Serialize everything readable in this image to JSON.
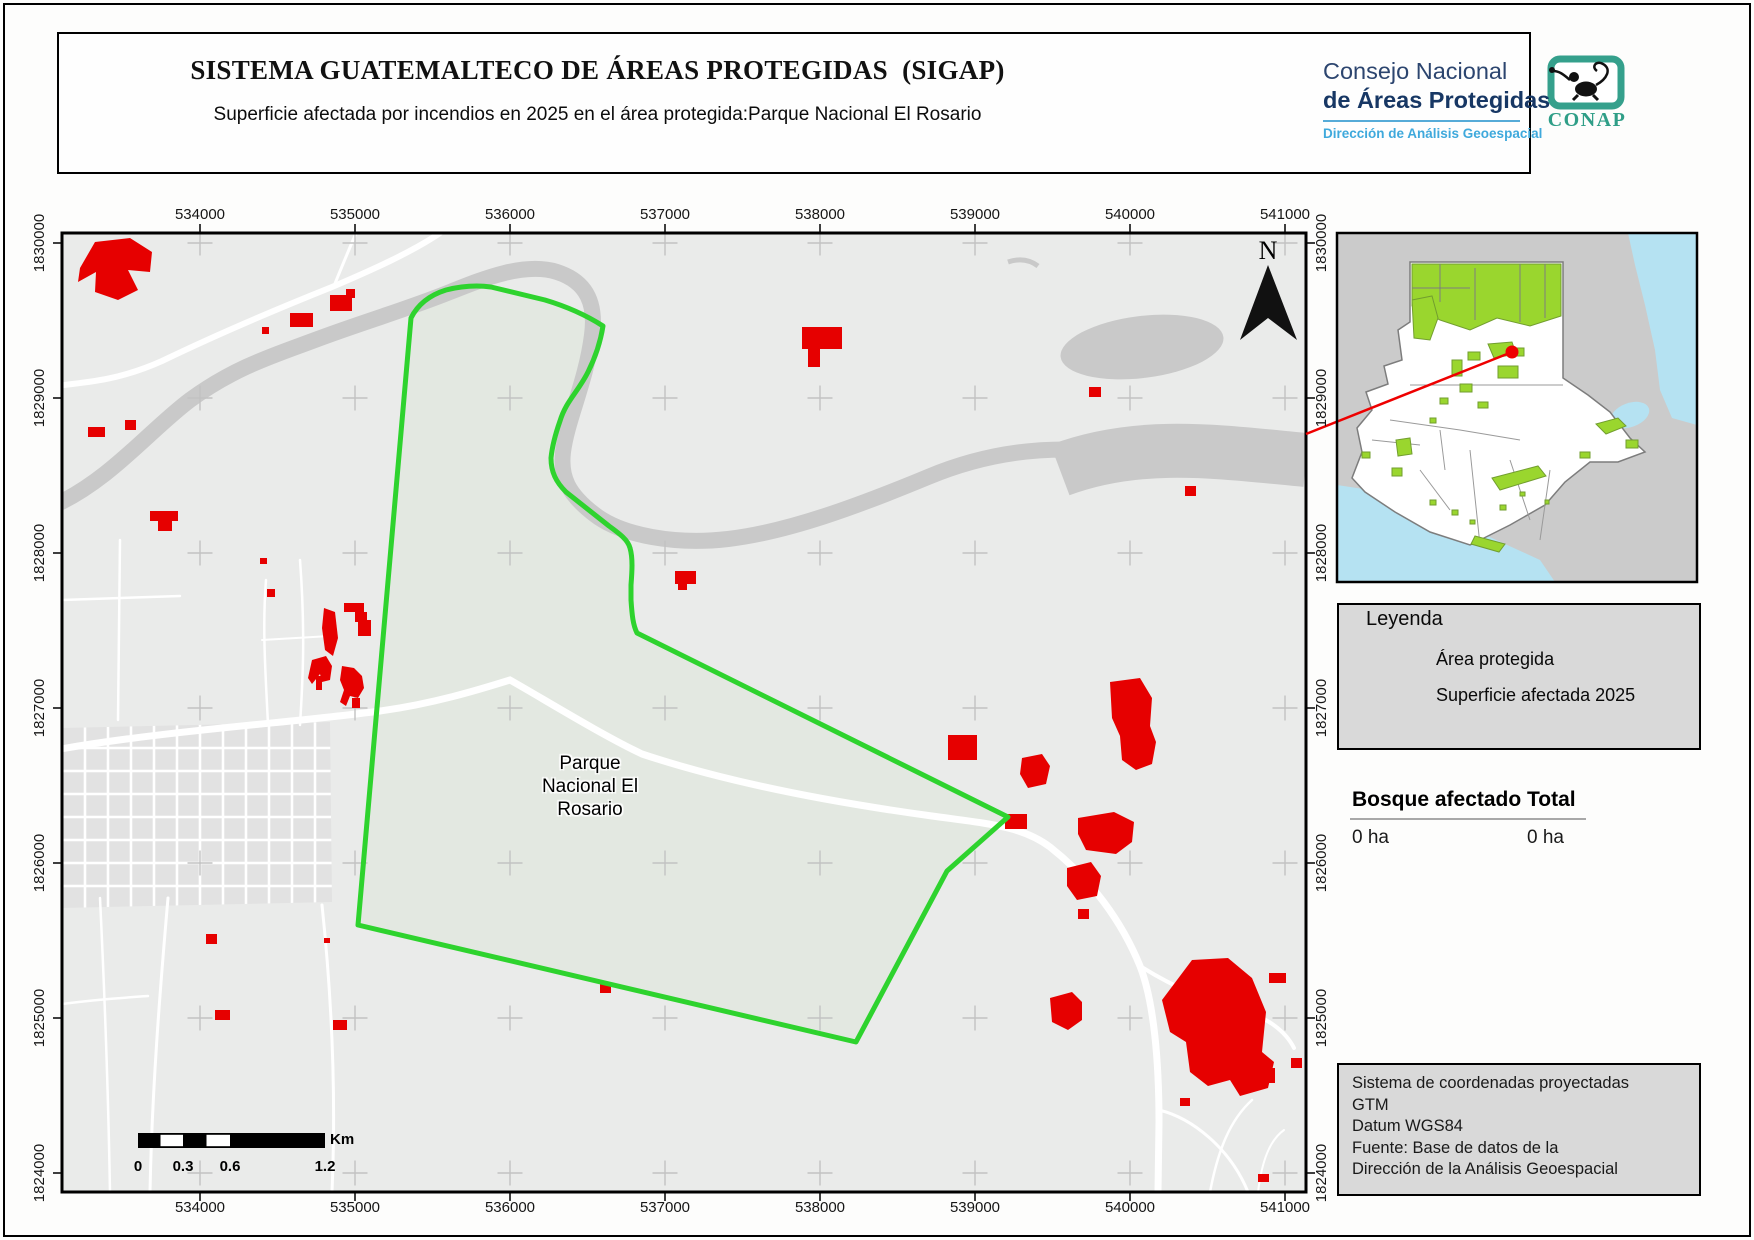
{
  "header": {
    "title": "SISTEMA GUATEMALTECO DE ÁREAS PROTEGIDAS  (SIGAP)",
    "subtitle": "Superficie afectada por incendios en 2025 en el área protegida:Parque Nacional El Rosario"
  },
  "branding": {
    "gov_seal": {
      "ring_top": "GOBIERNO DE LA REPÚBLICA",
      "ring_bottom": "GUATEMALA"
    },
    "council": {
      "line1": "Consejo Nacional",
      "line2": "de Áreas Protegidas",
      "line3": "Dirección de Análisis Geoespacial"
    },
    "conap": {
      "label": "CONAP"
    }
  },
  "map": {
    "park_label": {
      "line1": "Parque",
      "line2": "Nacional El",
      "line3": "Rosario"
    },
    "north_label": "N",
    "axis": {
      "x_labels": [
        "534000",
        "535000",
        "536000",
        "537000",
        "538000",
        "539000",
        "540000",
        "541000"
      ],
      "y_labels": [
        "1830000",
        "1829000",
        "1828000",
        "1827000",
        "1826000",
        "1825000",
        "1824000"
      ]
    },
    "scalebar": {
      "ticks": [
        "0",
        "0.3",
        "0.6",
        "1.2"
      ],
      "unit": "Km"
    }
  },
  "legend": {
    "title": "Leyenda",
    "items": [
      {
        "label": "Área protegida",
        "style": "green-outline"
      },
      {
        "label": "Superficie afectada 2025",
        "style": "red-fill"
      }
    ]
  },
  "stats": {
    "headers": [
      "Bosque afectado",
      "Total"
    ],
    "values": [
      "0 ha",
      "0 ha"
    ]
  },
  "meta": {
    "lines": [
      "Sistema de coordenadas proyectadas",
      "GTM",
      "Datum WGS84",
      "Fuente: Base de datos de la",
      "Dirección de la Análisis Geoespacial"
    ]
  },
  "colors": {
    "protected_outline": "#2ed32e",
    "affected_fill": "#e60000",
    "water": "#b5e2f2",
    "inset_protected": "#9ad62e",
    "navy": "#1c3667",
    "light_blue": "#3fa9dc",
    "teal": "#35a08c"
  }
}
